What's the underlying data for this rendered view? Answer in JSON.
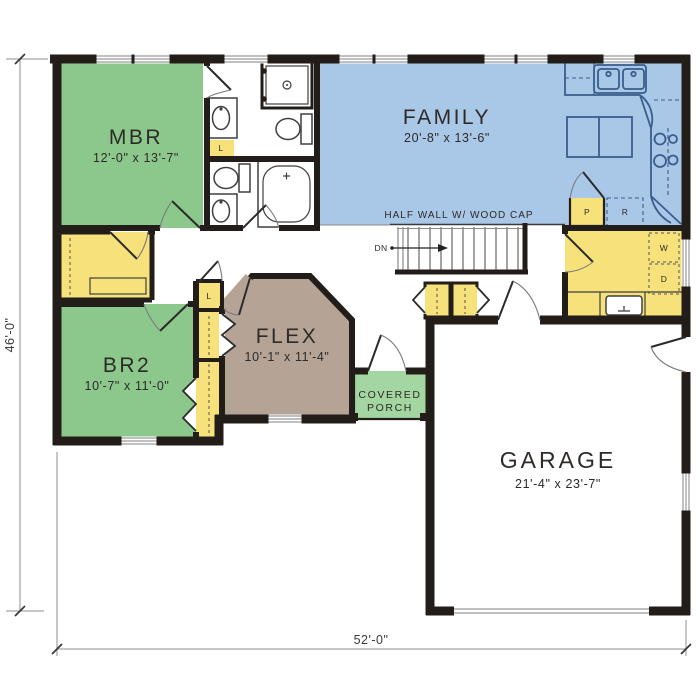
{
  "palette": {
    "wall": "#231d1a",
    "room_green": "#8cc88c",
    "porch_green": "#a3d6a0",
    "room_blue": "#a9c7e7",
    "room_yellow": "#f6e17b",
    "room_taupe": "#b5a496",
    "kitchen_line": "#3a5d8c",
    "white_floor": "#ffffff",
    "dim_line": "#8f8f8f",
    "text": "#2e2a28"
  },
  "rooms": {
    "mbr": {
      "name": "MBR",
      "dims": "12'-0\" x 13'-7\""
    },
    "family": {
      "name": "FAMILY",
      "dims": "20'-8\" x 13'-6\""
    },
    "br2": {
      "name": "BR2",
      "dims": "10'-7\" x 11'-0\""
    },
    "flex": {
      "name": "FLEX",
      "dims": "10'-1\" x 11'-4\""
    },
    "garage": {
      "name": "GARAGE",
      "dims": "21'-4\" x 23'-7\""
    },
    "porch": {
      "line1": "COVERED",
      "line2": "PORCH"
    }
  },
  "annotations": {
    "half_wall": "HALF WALL W/ WOOD CAP",
    "stair_direction": "DN"
  },
  "fixtures": {
    "linen_master": "L",
    "linen_hall": "L",
    "pantry": "P",
    "refrigerator": "R",
    "washer": "W",
    "dryer": "D"
  },
  "dimensions": {
    "overall_depth": "46'-0\"",
    "overall_width": "52'-0\""
  }
}
